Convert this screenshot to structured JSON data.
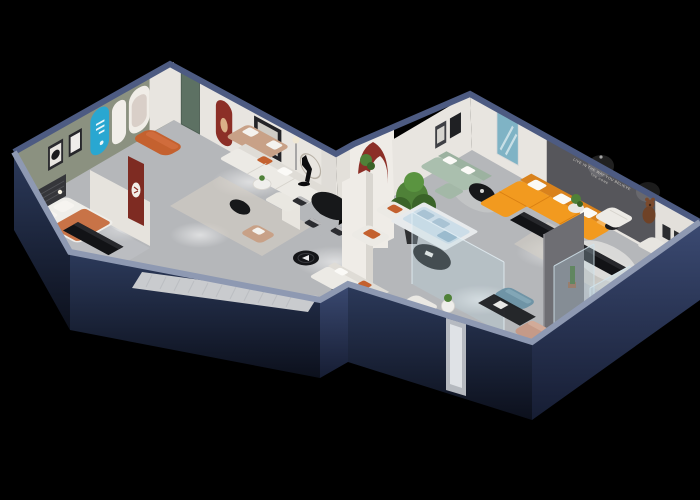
{
  "scene": {
    "title": "3D isometric cutaway render of a furniture showroom floor plan",
    "background": "#000000",
    "wall_slogan": {
      "line1": "LIVE IN THE WAY YOU BELIEVE",
      "line2": "THE HOME",
      "color": "#d8d4cd"
    },
    "colors": {
      "navy_hi": "#2c3a5b",
      "navy_lo": "#0c101c",
      "navy_hi2": "#3b4a72",
      "navy_lo2": "#161d33",
      "cap_near": "#8e99b2",
      "cap_far": "#4d5b82",
      "floor": "#b5b7ba",
      "floor_light": "#d8d9db",
      "walkway": "#c9cbce",
      "wall_white": "#e8e5e0",
      "wall_cream": "#efece7",
      "wall_green": "#8b9180",
      "wall_dark": "#56565b",
      "arch_cyan": "#29a7d1",
      "arch_red": "#8c2f27",
      "panel_red": "#7e2b22",
      "door_green": "#5d7163",
      "sofa_white": "#eceae5",
      "sofa_orange": "#f29a1f",
      "sofa_orange_dk": "#d9821c",
      "sofa_sage": "#aabfae",
      "sofa_tan": "#c8a187",
      "pillow_rust": "#c4612f",
      "table_black": "#17181a",
      "console_black": "#121316",
      "plant": "#4f8138",
      "plant_dk": "#3a6328",
      "glass": "#bcd6e4",
      "glass_edge": "#d6e7f0",
      "rug": "#d5cfc4",
      "rug_white": "#dfdfdd",
      "bed_white": "#efeeea",
      "blanket": "#c87347",
      "ottoman_blue": "#6f94a6",
      "chair_blush": "#c59a88",
      "bear": "#7b4a2d",
      "art_teal": "#7fb3c5",
      "slat_dark": "#35363a"
    },
    "furniture": [
      "bed",
      "headboard-slats",
      "white-sofa",
      "tan-loveseat",
      "rust-ottoman",
      "dining-table",
      "dining-chairs",
      "sculpture",
      "potted-tree",
      "armchairs",
      "oval-coffee-tables",
      "orange-sectional-sofa",
      "sage-sofa",
      "media-consoles",
      "glass-vitrine",
      "display-cases",
      "teddy-bear-figure",
      "blue-ottoman",
      "blush-armchair",
      "rugs",
      "entry-disc",
      "red-arch-panel",
      "cyan-arch-panel",
      "poster-arch",
      "wall-frames",
      "teal-artwork",
      "floor-lamp"
    ]
  }
}
